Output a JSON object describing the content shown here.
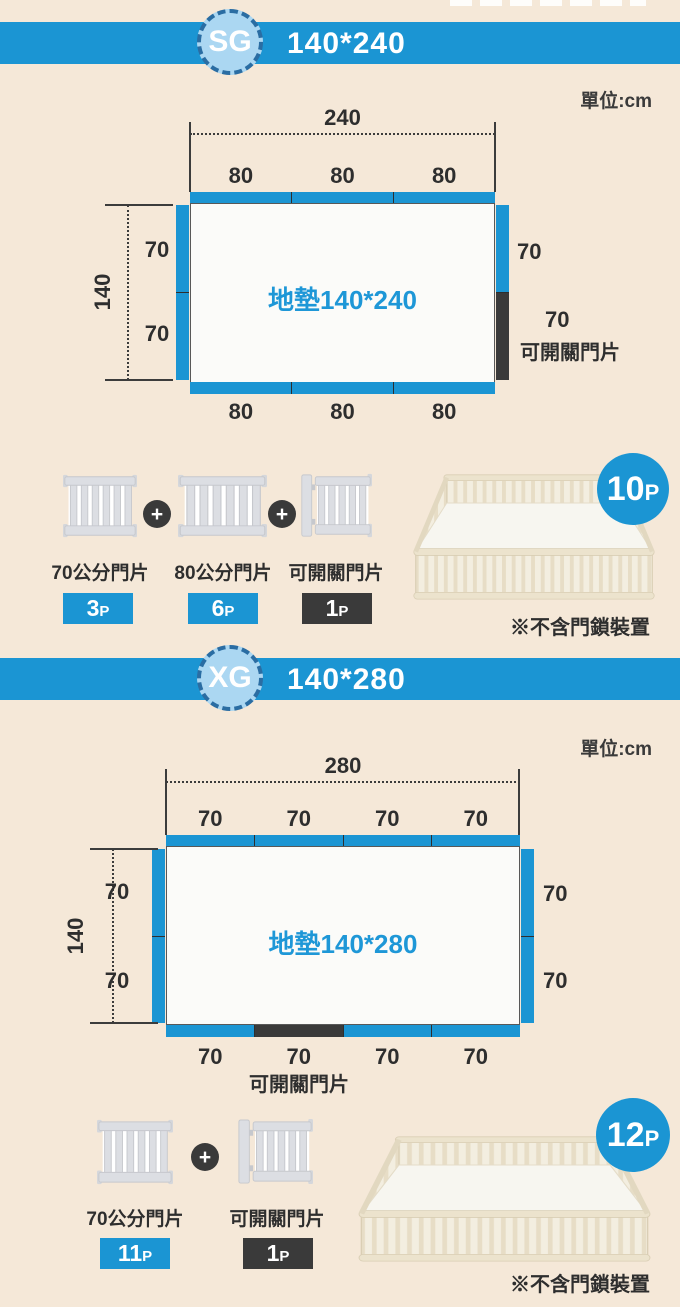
{
  "colors": {
    "accent_blue": "#1b95d3",
    "dark": "#3a3a3a",
    "badge_fill": "#abd7f2",
    "badge_border": "#2a6da3",
    "background": "#f5e8d8",
    "mat_text_blue": "#1e97d7"
  },
  "sg": {
    "code": "SG",
    "size": "140*240",
    "unit": "單位:cm",
    "dim_width": "240",
    "dim_height": "140",
    "top_labels": [
      "80",
      "80",
      "80"
    ],
    "bottom_labels": [
      "80",
      "80",
      "80"
    ],
    "left_labels": [
      "70",
      "70"
    ],
    "right_label": "70",
    "door_label": "70",
    "door_note": "可開關門片",
    "mat_label": "地墊140*240",
    "plus": "+",
    "parts": [
      {
        "name": "70公分門片",
        "count": "3",
        "unit": "P"
      },
      {
        "name": "80公分門片",
        "count": "6",
        "unit": "P"
      },
      {
        "name": "可開關門片",
        "count": "1",
        "unit": "P"
      }
    ],
    "total_count": "10",
    "total_unit": "P",
    "note": "※不含門鎖裝置"
  },
  "xg": {
    "code": "XG",
    "size": "140*280",
    "unit": "單位:cm",
    "dim_width": "280",
    "dim_height": "140",
    "top_labels": [
      "70",
      "70",
      "70",
      "70"
    ],
    "bottom_labels": [
      "70",
      "70",
      "70",
      "70"
    ],
    "left_labels": [
      "70",
      "70"
    ],
    "right_labels": [
      "70",
      "70"
    ],
    "door_note": "可開關門片",
    "mat_label": "地墊140*280",
    "plus": "+",
    "parts": [
      {
        "name": "70公分門片",
        "count": "11",
        "unit": "P"
      },
      {
        "name": "可開關門片",
        "count": "1",
        "unit": "P"
      }
    ],
    "total_count": "12",
    "total_unit": "P",
    "note": "※不含門鎖裝置"
  }
}
